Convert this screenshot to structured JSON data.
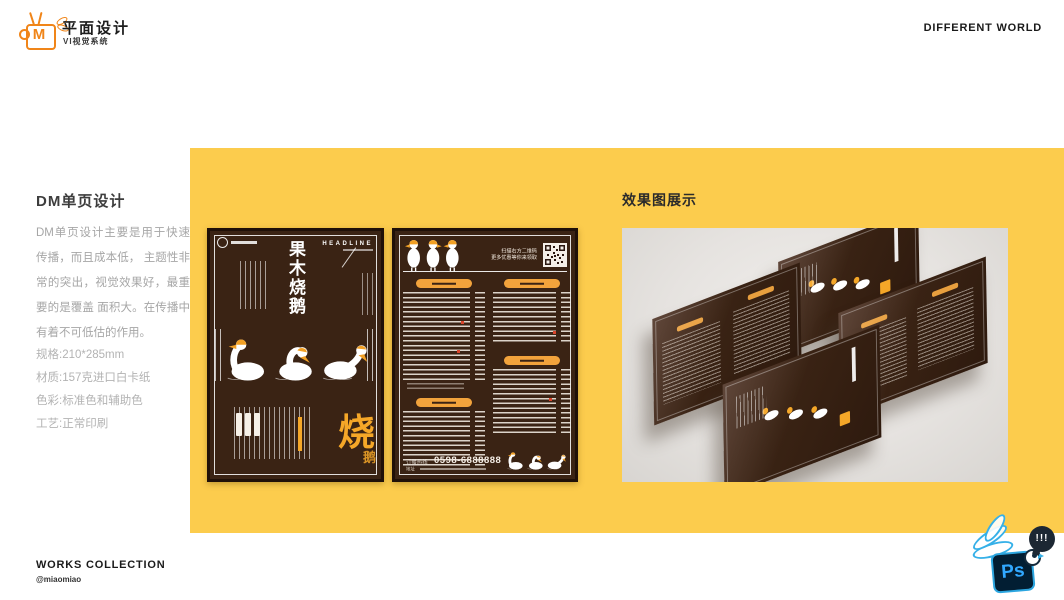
{
  "header": {
    "logo_letter": "M",
    "title": "平面设计",
    "subtitle": "VI视觉系统",
    "right_text": "DIFFERENT WORLD"
  },
  "left_panel": {
    "title": "DM单页设计",
    "description": "DM单页设计主要是用于快速传播，而且成本低， 主题性非常的突出，视觉效果好，最重要的是覆盖 面积大。在传播中有着不可低估的作用。",
    "specs": [
      "规格:210*285mm",
      "材质:157克进口白卡纸",
      "色彩:标准色和辅助色",
      "工艺:正常印刷"
    ]
  },
  "showcase": {
    "title": "效果图展示"
  },
  "cover_flyer": {
    "headline": "HEADLINE",
    "title": "果木烧鹅",
    "big_char": "烧",
    "small_char": "鹅"
  },
  "menu_flyer": {
    "qr_note_line1": "扫描右方二维码",
    "qr_note_line2": "更多优惠等你来领取",
    "hotline_label": "订餐热线",
    "phone": "0598-6888888",
    "address_label": "地址"
  },
  "footer": {
    "title": "WORKS COLLECTION",
    "handle": "@miaomiao"
  },
  "ps_badge": {
    "label": "Ps",
    "bubble": "!!!"
  },
  "colors": {
    "panel_yellow": "#FCCC4D",
    "flyer_brown": "#3A2314",
    "accent_orange": "#F5A728",
    "ps_blue": "#31A8FF",
    "logo_orange": "#F08519"
  }
}
